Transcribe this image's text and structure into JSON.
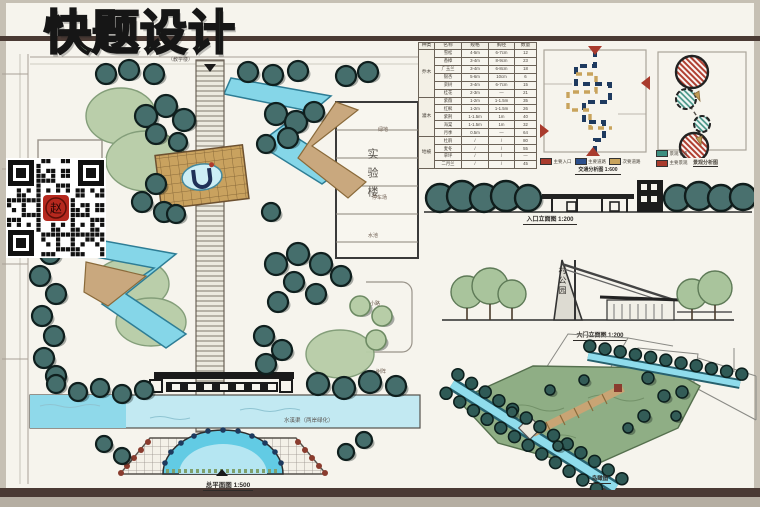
{
  "board": {
    "title": "快题设计"
  },
  "colors": {
    "paper": "#f6f4ed",
    "rule_brown": "#4a3a34",
    "title_green": "#9ec6a6",
    "tree_dark_teal": "#456e6c",
    "tree_light_green": "#b7cda7",
    "water_blue": "#85d6e8",
    "wood_tan": "#c9a87e",
    "plaza_gold": "#c9a25f",
    "red_accent": "#a93b2d",
    "navy_path": "#2c4f8c"
  },
  "master_plan": {
    "caption": "总平面图",
    "scale": "1:500",
    "building_label": "实验楼",
    "top_label": "（教学楼）",
    "water_label": "水溪渠（两岸绿化）",
    "annotations": [
      "绿地",
      "停车场",
      "水池",
      "小路",
      "树阵"
    ]
  },
  "plant_table": {
    "headers": [
      "种类",
      "名称",
      "规格",
      "胸径",
      "数量"
    ],
    "rows": [
      [
        "乔木",
        "雪松",
        "4-5m",
        "6-7cm",
        "12"
      ],
      [
        "",
        "香樟",
        "3-4m",
        "8-9cm",
        "23"
      ],
      [
        "",
        "广玉兰",
        "3-4m",
        "6-8cm",
        "18"
      ],
      [
        "",
        "银杏",
        "5-6m",
        "10cm",
        "6"
      ],
      [
        "",
        "栾树",
        "3-4m",
        "6-7cm",
        "15"
      ],
      [
        "",
        "桂花",
        "2-3m",
        "—",
        "21"
      ],
      [
        "灌木",
        "紫薇",
        "1-2m",
        "1-1.5m",
        "35"
      ],
      [
        "",
        "红枫",
        "1-2m",
        "1-1.5m",
        "26"
      ],
      [
        "",
        "紫荆",
        "1-1.5m",
        "1m",
        "40"
      ],
      [
        "",
        "海棠",
        "1-1.5m",
        "1m",
        "32"
      ],
      [
        "",
        "月季",
        "0.5m",
        "—",
        "64"
      ],
      [
        "地被",
        "杜鹃",
        "/",
        "/",
        "80"
      ],
      [
        "",
        "麦冬",
        "/",
        "/",
        "55"
      ],
      [
        "",
        "草坪",
        "/",
        "/",
        "—"
      ],
      [
        "",
        "二月兰",
        "/",
        "/",
        "45"
      ]
    ]
  },
  "traffic_diagram": {
    "caption": "交通分析图",
    "scale": "1:600",
    "legend": [
      {
        "label": "主要入口",
        "color": "#a93b2d"
      },
      {
        "label": "主要道路",
        "color": "#2c4f8c"
      },
      {
        "label": "次要道路",
        "color": "#c8a35c"
      }
    ]
  },
  "landscape_diagram": {
    "caption": "景观分析图",
    "legend": [
      {
        "label": "景观节点",
        "color": "#3d8f80"
      },
      {
        "label": "主要景观",
        "color": "#a93b2d"
      }
    ]
  },
  "elevations": [
    {
      "caption": "入口立面图",
      "scale": "1:200"
    },
    {
      "caption": "大门立面图",
      "scale": "1:200",
      "gate_sign": "村公园"
    }
  ],
  "perspective": {
    "caption": "鸟瞰图"
  },
  "qr": {
    "seal": "赵"
  }
}
